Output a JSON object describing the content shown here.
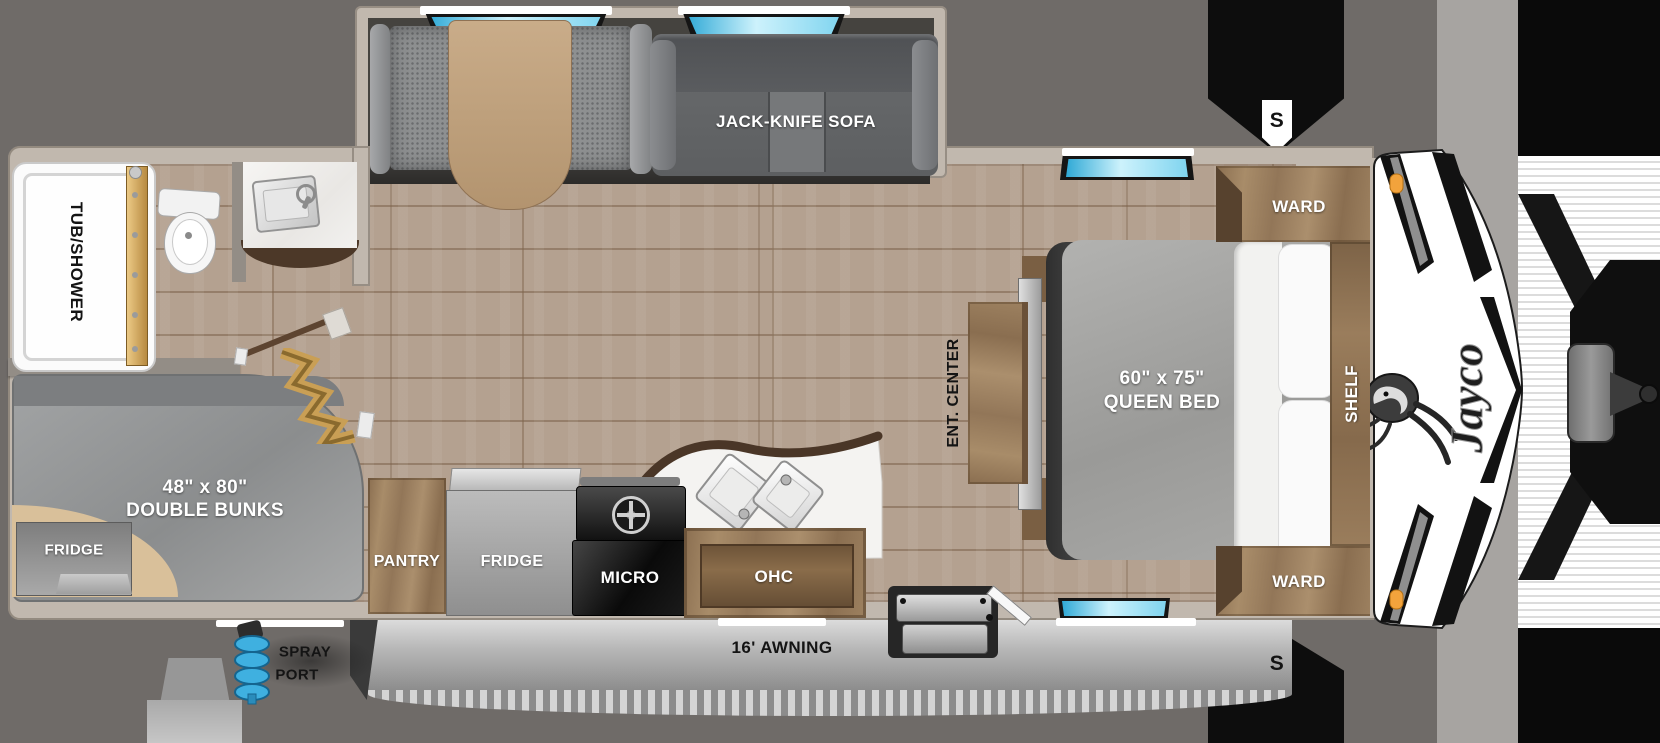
{
  "labels": {
    "tub_shower": "TUB/SHOWER",
    "jack_knife_sofa": "JACK-KNIFE SOFA",
    "ward_top": "WARD",
    "ward_bottom": "WARD",
    "shelf": "SHELF",
    "queen_bed_line1": "60\" x 75\"",
    "queen_bed_line2": "QUEEN BED",
    "ent_center": "ENT. CENTER",
    "bunks_line1": "48\" x 80\"",
    "bunks_line2": "DOUBLE BUNKS",
    "fridge_bunk": "FRIDGE",
    "pantry": "PANTRY",
    "fridge_kitchen": "FRIDGE",
    "micro": "MICRO",
    "ohc": "OHC",
    "awning": "16' AWNING",
    "spray_port_line1": "SPRAY",
    "spray_port_line2": "PORT",
    "stabilizer_front": "S",
    "stabilizer_rear": "S",
    "brand": "Jayco"
  },
  "colors": {
    "background": "#6f6b68",
    "floor_wood": "#b4a190",
    "cabinet_wood": "#9b7f5f",
    "wall_trim": "#c1b8ae",
    "mattress_gray": "#a0a09e",
    "window_glass": "#7fd4ef",
    "marker_light_orange": "#f2a33c",
    "awning_silver": "#b9b9b9",
    "hose_blue": "#3fb0e0"
  }
}
